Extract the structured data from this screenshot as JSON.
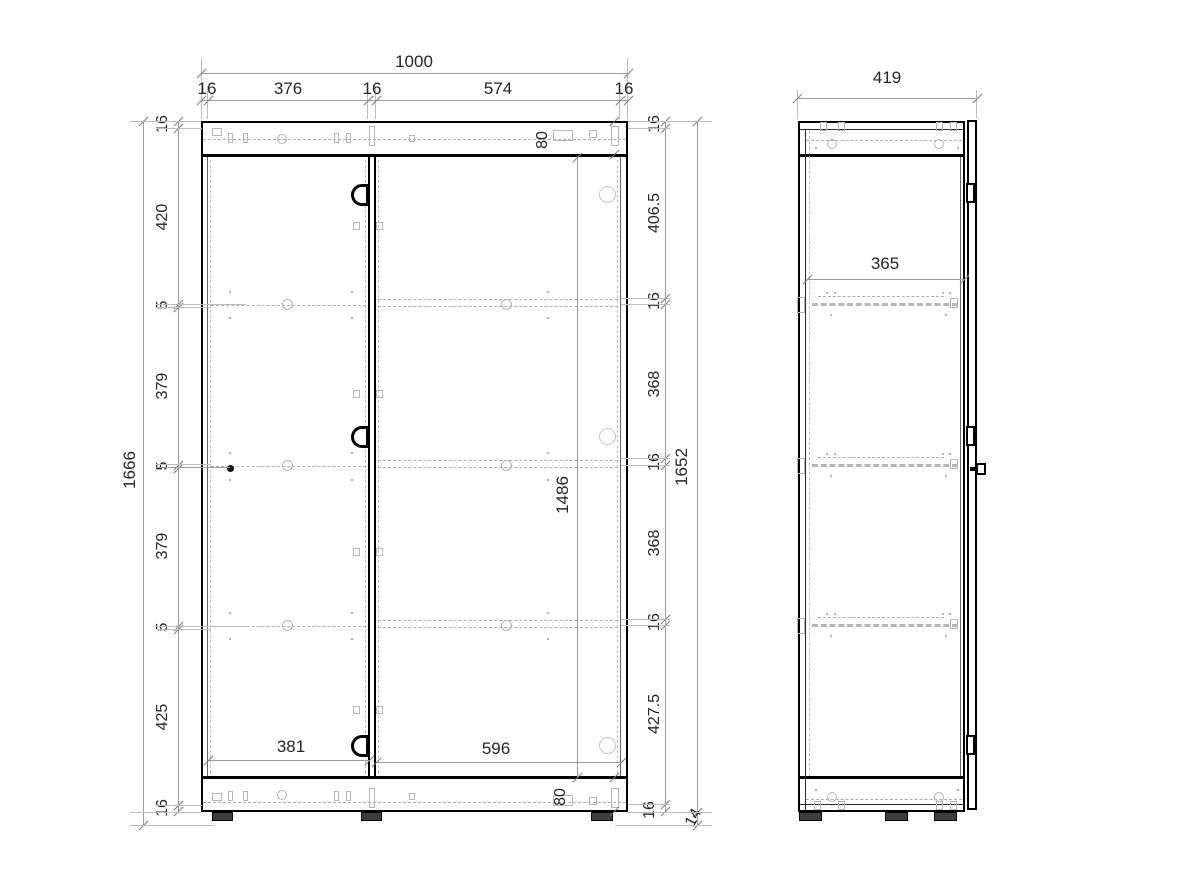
{
  "drawing_type": "furniture cabinet technical drawing, front and side elevation",
  "front": {
    "total_width": "1000",
    "top_segments": [
      "16",
      "376",
      "16",
      "574",
      "16"
    ],
    "left_chain": [
      "16",
      "420",
      "5",
      "379",
      "5",
      "379",
      "5",
      "425",
      "16"
    ],
    "total_height": "1666",
    "right_chain": [
      "16",
      "406.5",
      "16",
      "368",
      "16",
      "368",
      "16",
      "427.5",
      "16"
    ],
    "body_height": "1652",
    "plinth_height": "14",
    "top_rail_height": "80",
    "bottom_rail_height": "80",
    "left_door_width": "381",
    "right_door_width": "596",
    "right_door_height": "1486"
  },
  "side": {
    "total_depth": "419",
    "inner_depth": "365"
  },
  "colors": {
    "outline": "#000000",
    "dimension_line": "#9c9c9c",
    "hidden_line": "#b7b7b7",
    "text": "#262626",
    "background": "#ffffff"
  }
}
